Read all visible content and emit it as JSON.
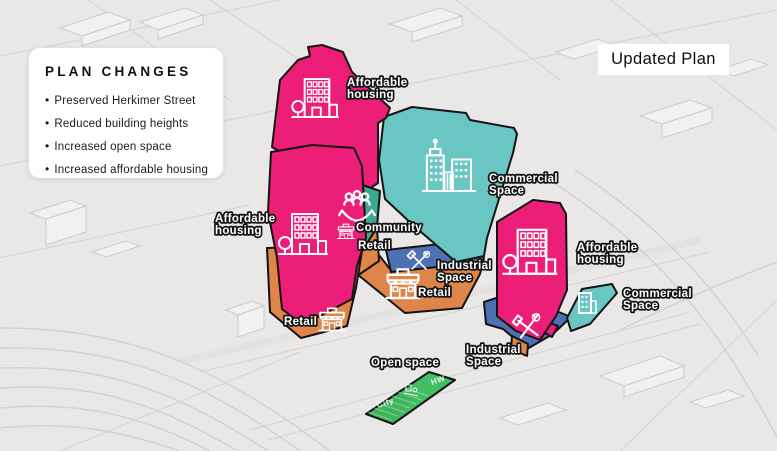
{
  "title_box": {
    "label": "Updated Plan"
  },
  "panel": {
    "title": "PLAN CHANGES",
    "bullets": [
      "Preserved Herkimer Street",
      "Reduced building heights",
      "Increased open space",
      "Increased affordable housing"
    ]
  },
  "zones": {
    "affordable_top": {
      "label_line1": "Affordable",
      "label_line2": "housing"
    },
    "affordable_left": {
      "label_line1": "Affordable",
      "label_line2": "housing"
    },
    "affordable_right": {
      "label_line1": "Affordable",
      "label_line2": "housing"
    },
    "commercial_main": {
      "label_line1": "Commercial",
      "label_line2": "Space"
    },
    "commercial_right": {
      "label_line1": "Commercial",
      "label_line2": "Space"
    },
    "industrial_mid": {
      "label_line1": "Industrial",
      "label_line2": "Space"
    },
    "industrial_right": {
      "label_line1": "Industrial",
      "label_line2": "Space"
    },
    "community": {
      "label": "Community"
    },
    "retail_upper": {
      "label": "Retail"
    },
    "retail_mid": {
      "label": "Retail"
    },
    "retail_left": {
      "label": "Retail"
    },
    "open_space": {
      "label": "Open space",
      "marking_left": "City",
      "marking_right": "HW"
    }
  },
  "colors": {
    "affordable_housing": "#EC1E78",
    "commercial_space": "#6AC6C3",
    "community_space": "#3EA88C",
    "retail": "#E0854A",
    "industrial": "#4E71B3",
    "open_space": "#41BE63",
    "outline": "#141414",
    "background": "#E9E8E7"
  }
}
